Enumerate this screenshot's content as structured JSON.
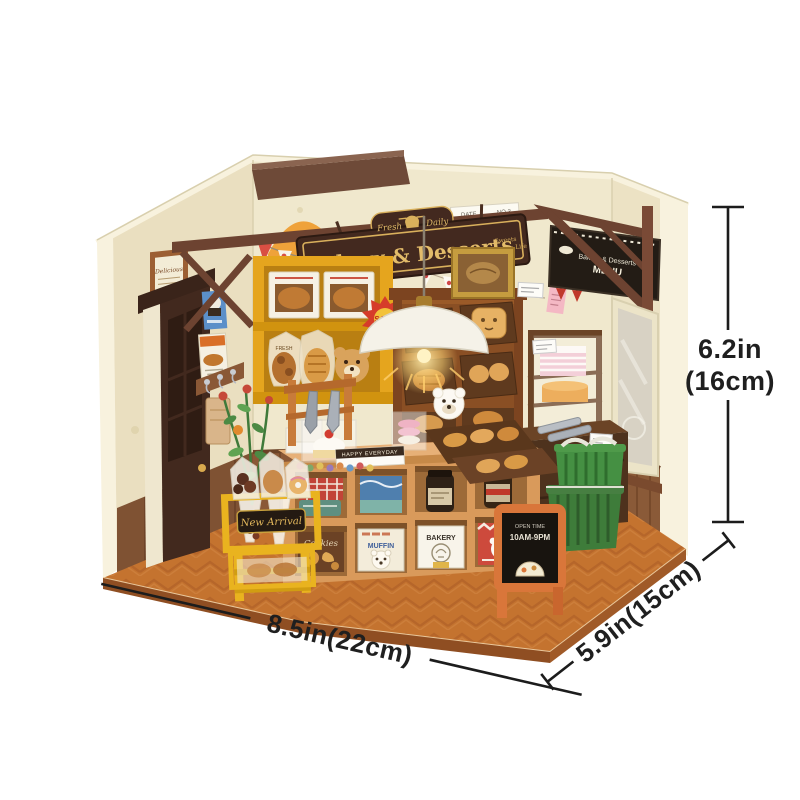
{
  "product": {
    "signboard": {
      "brand": "Rolife",
      "badge_left": "Fresh",
      "badge_right": "Daily",
      "title": "Bakery & Desserts",
      "tagline_top": "Sweets",
      "tagline_bottom": "Decorate Life"
    },
    "menu_board": {
      "title": "Bakery & Desserts",
      "subtitle": "MENU"
    },
    "wall_note": {
      "date_label": "DATE",
      "number_label": "NO.3"
    },
    "framed_print": {
      "caption": "Delicious"
    },
    "cabinet": {
      "sale_sticker": "SALE",
      "bag_text": "FRESH"
    },
    "counter": {
      "happy_box": "HAPPY EVERYDAY"
    },
    "boxes": {
      "cookies": "Cookies",
      "muffin": "MUFFIN",
      "bakery": "BAKERY"
    },
    "cart": {
      "sign": "New Arrival"
    },
    "open_sign": {
      "line1": "OPEN TIME",
      "line2": "10AM-9PM"
    }
  },
  "dimensions": {
    "height_in": "6.2in",
    "height_cm": "(16cm)",
    "width": "8.5in(22cm)",
    "depth": "5.9in(15cm)"
  },
  "colors": {
    "wall_cream": "#f0e8cd",
    "floor_wood": "#c4732f",
    "beam_brown": "#6d4331",
    "sign_bg": "#43291f",
    "sign_gold": "#d9b05c",
    "cabinet_yellow": "#e5a51e",
    "cart_yellow": "#e9b31f",
    "basket_green": "#3e7c3a",
    "aframe_orange": "#d9763a",
    "dimension_line": "#1c1c1c"
  }
}
